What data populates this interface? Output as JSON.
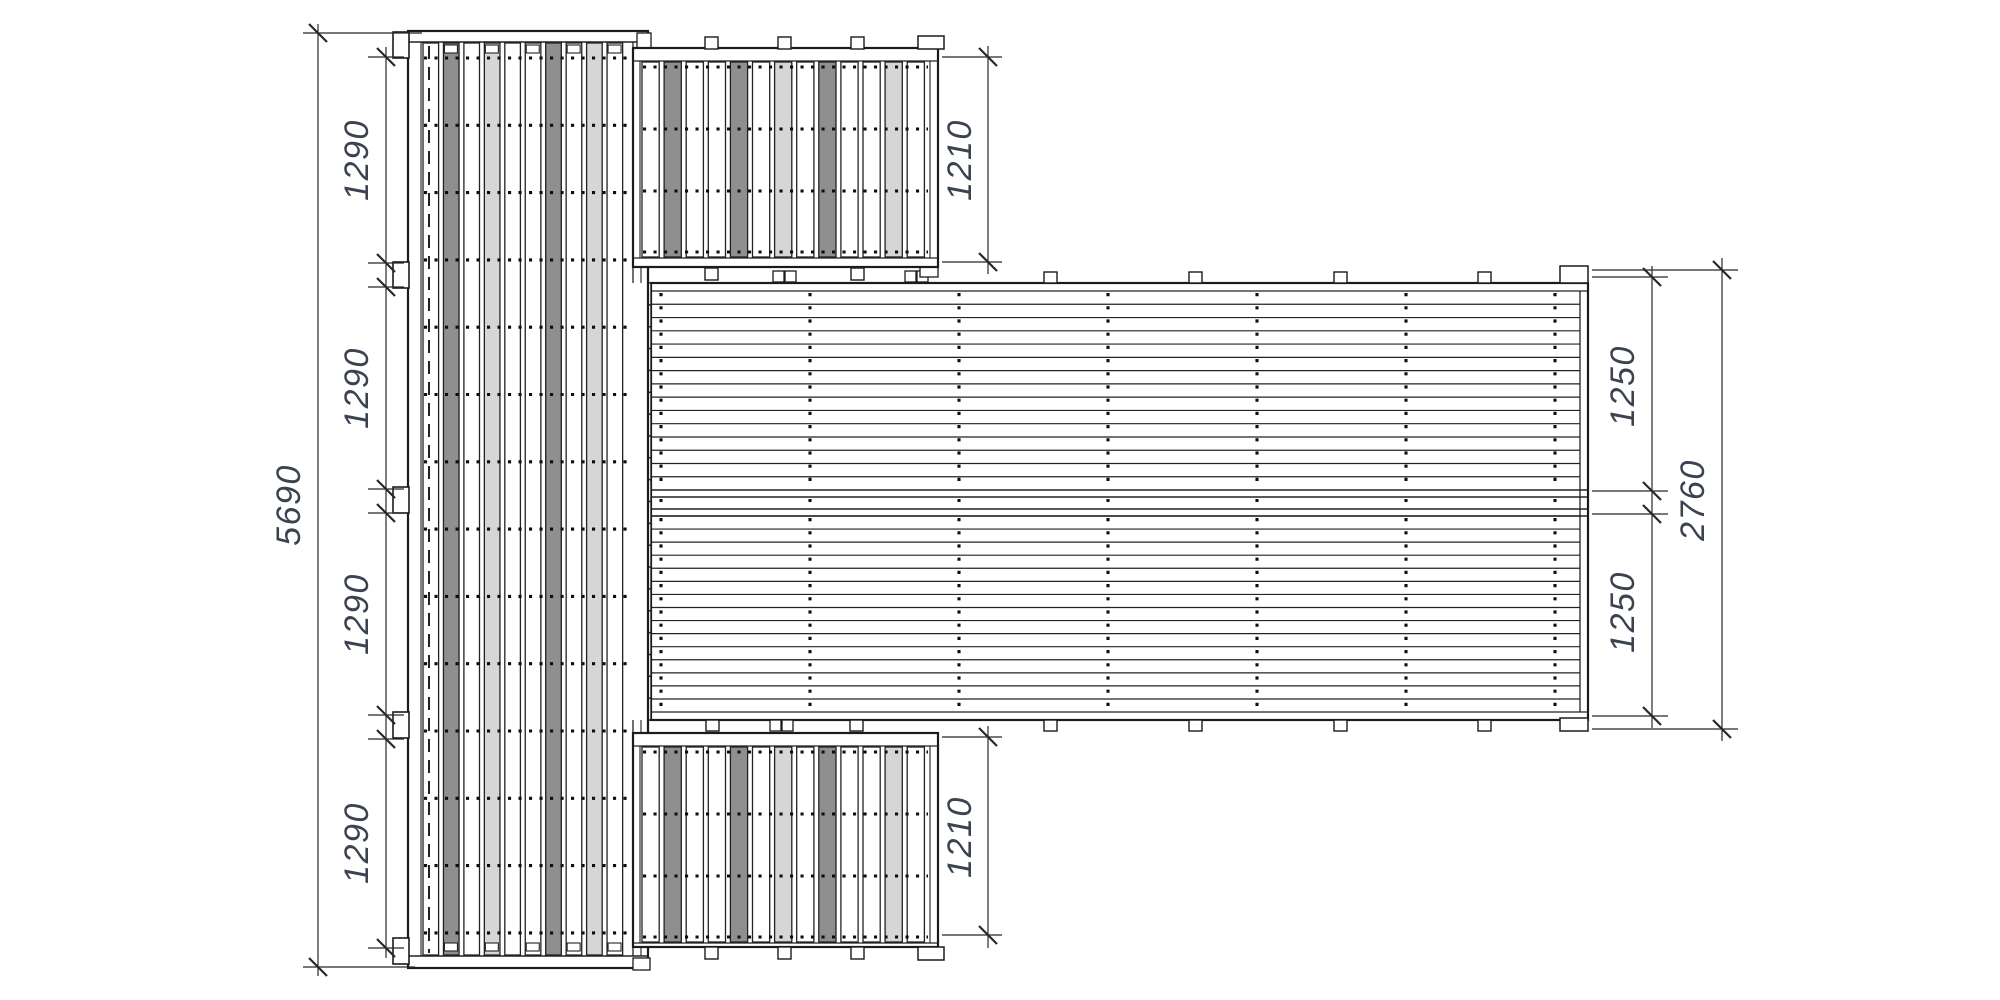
{
  "dimensions": {
    "left_segments": [
      "1290",
      "1290",
      "1290",
      "1290"
    ],
    "left_total": "5690",
    "top_wing": "1210",
    "bottom_wing": "1210",
    "right_segments": [
      "1250",
      "1250"
    ],
    "right_total": "2760"
  },
  "colors": {
    "background": "#ffffff",
    "outline": "#1b1b1b",
    "plank_edge": "#222222",
    "plank_fill": "#ffffff",
    "plank_gray": "#8f8f8f",
    "plank_light": "#d6d6d6",
    "screw_dot": "#0e0e0e",
    "dim_line": "#26282b",
    "dim_text": "#3b4250"
  }
}
